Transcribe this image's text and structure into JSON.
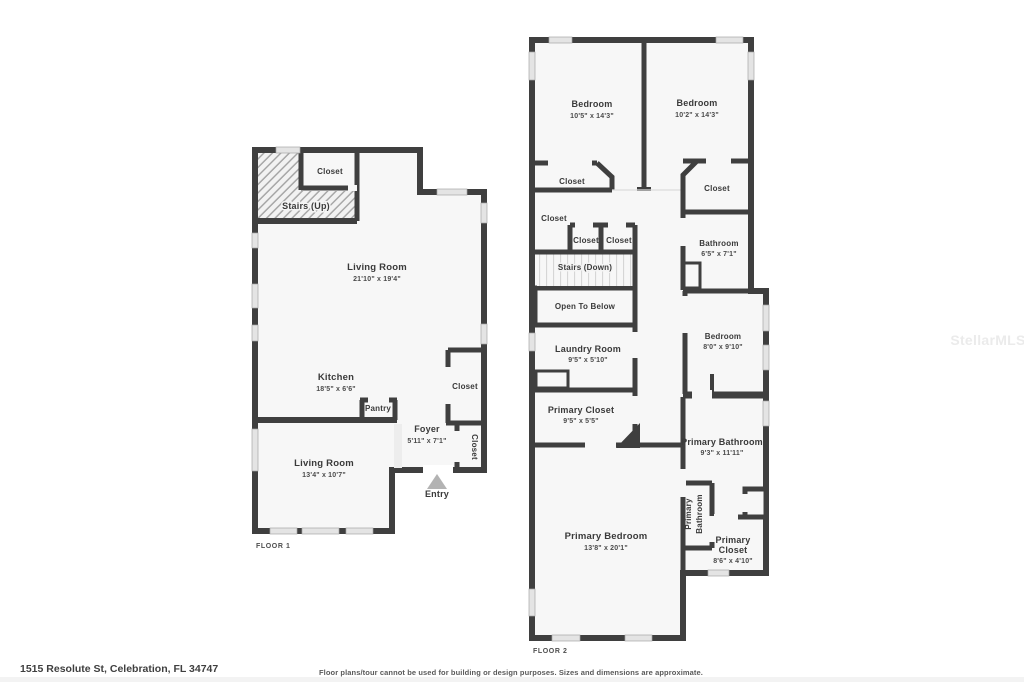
{
  "meta": {
    "address": "1515 Resolute St, Celebration, FL 34747",
    "disclaimer": "Floor plans/tour cannot be used for building or design purposes. Sizes and dimensions are approximate.",
    "watermark": "StellarMLS"
  },
  "colors": {
    "wall": "#3f3f3f",
    "room_fill": "#f7f7f7",
    "open_to_below_fill": "#ececec",
    "window": "#e4e4e4",
    "entry_arrow": "#b3b3b3",
    "text": "#3a3a3a"
  },
  "floor1": {
    "title": "FLOOR 1",
    "rooms": {
      "closet_top": {
        "name": "Closet"
      },
      "stairs_up": {
        "name": "Stairs (Up)"
      },
      "living_main": {
        "name": "Living Room",
        "dims": "21'10\" x 19'4\""
      },
      "kitchen": {
        "name": "Kitchen",
        "dims": "18'5\" x 6'6\""
      },
      "pantry": {
        "name": "Pantry"
      },
      "closet_right": {
        "name": "Closet"
      },
      "foyer": {
        "name": "Foyer",
        "dims": "5'11\" x 7'1\""
      },
      "closet_entry": {
        "name": "Closet"
      },
      "living_lower": {
        "name": "Living Room",
        "dims": "13'4\" x 10'7\""
      },
      "entry": {
        "name": "Entry"
      }
    }
  },
  "floor2": {
    "title": "FLOOR 2",
    "rooms": {
      "bedroom_left": {
        "name": "Bedroom",
        "dims": "10'5\" x 14'3\""
      },
      "bedroom_right": {
        "name": "Bedroom",
        "dims": "10'2\" x 14'3\""
      },
      "closet_below_left_bedroom": {
        "name": "Closet"
      },
      "closet_below_right_bedroom": {
        "name": "Closet"
      },
      "closet_hall": {
        "name": "Closet"
      },
      "closet_small_1": {
        "name": "Closet"
      },
      "closet_small_2": {
        "name": "Closet"
      },
      "stairs_down": {
        "name": "Stairs (Down)"
      },
      "open_to_below": {
        "name": "Open To Below"
      },
      "bathroom": {
        "name": "Bathroom",
        "dims": "6'5\" x 7'1\""
      },
      "bedroom_small": {
        "name": "Bedroom",
        "dims": "8'0\" x 9'10\""
      },
      "laundry": {
        "name": "Laundry Room",
        "dims": "9'5\" x 5'10\""
      },
      "primary_closet": {
        "name": "Primary Closet",
        "dims": "9'5\" x 5'5\""
      },
      "primary_bathroom": {
        "name": "Primary Bathroom",
        "dims": "9'3\" x 11'11\""
      },
      "primary_bathroom_small": {
        "line1": "Primary",
        "line2": "Bathroom"
      },
      "primary_bedroom": {
        "name": "Primary Bedroom",
        "dims": "13'8\" x 20'1\""
      },
      "primary_closet_2": {
        "line1": "Primary",
        "line2": "Closet",
        "dims": "8'6\" x 4'10\""
      }
    }
  }
}
